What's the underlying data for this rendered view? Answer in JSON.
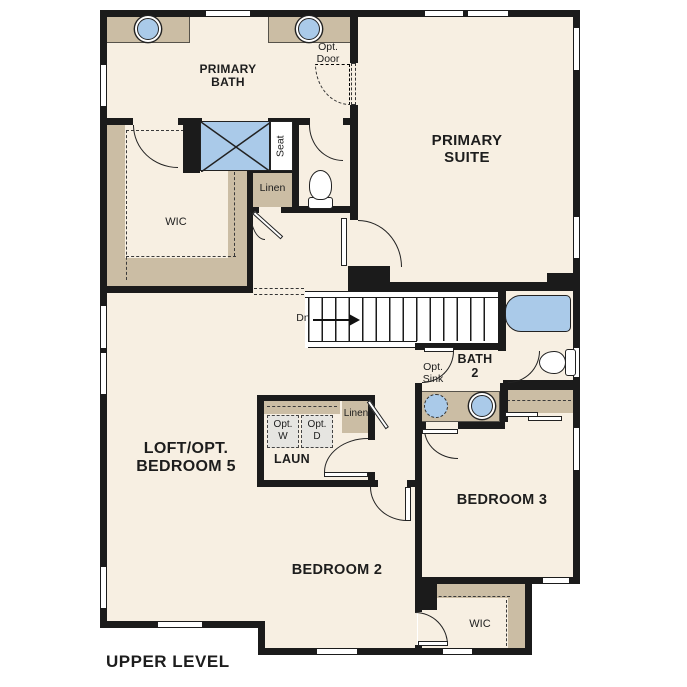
{
  "plan_title": "UPPER LEVEL",
  "rooms": {
    "primary_bath_l1": "PRIMARY",
    "primary_bath_l2": "BATH",
    "primary_suite_l1": "PRIMARY",
    "primary_suite_l2": "SUITE",
    "loft_l1": "LOFT/OPT.",
    "loft_l2": "BEDROOM 5",
    "laundry": "LAUN",
    "bedroom2": "BEDROOM 2",
    "bedroom3": "BEDROOM 3",
    "bath2_l1": "BATH",
    "bath2_l2": "2",
    "wic_primary": "WIC",
    "wic_bedroom2": "WIC",
    "linen_primary": "Linen",
    "linen_hall": "Linen"
  },
  "annotations": {
    "opt_door_l1": "Opt.",
    "opt_door_l2": "Door",
    "opt_sink_l1": "Opt.",
    "opt_sink_l2": "Sink",
    "opt_washer_l1": "Opt.",
    "opt_washer_l2": "W",
    "opt_dryer_l1": "Opt.",
    "opt_dryer_l2": "D",
    "stairs_down": "Dn",
    "shower_seat": "Seat"
  },
  "colors": {
    "floor": "#f7efe2",
    "wall": "#1b1b1b",
    "cabinet_tan": "#cbbda4",
    "fixture_blue": "#aacae9",
    "optional_gray": "#e6e5e1"
  }
}
